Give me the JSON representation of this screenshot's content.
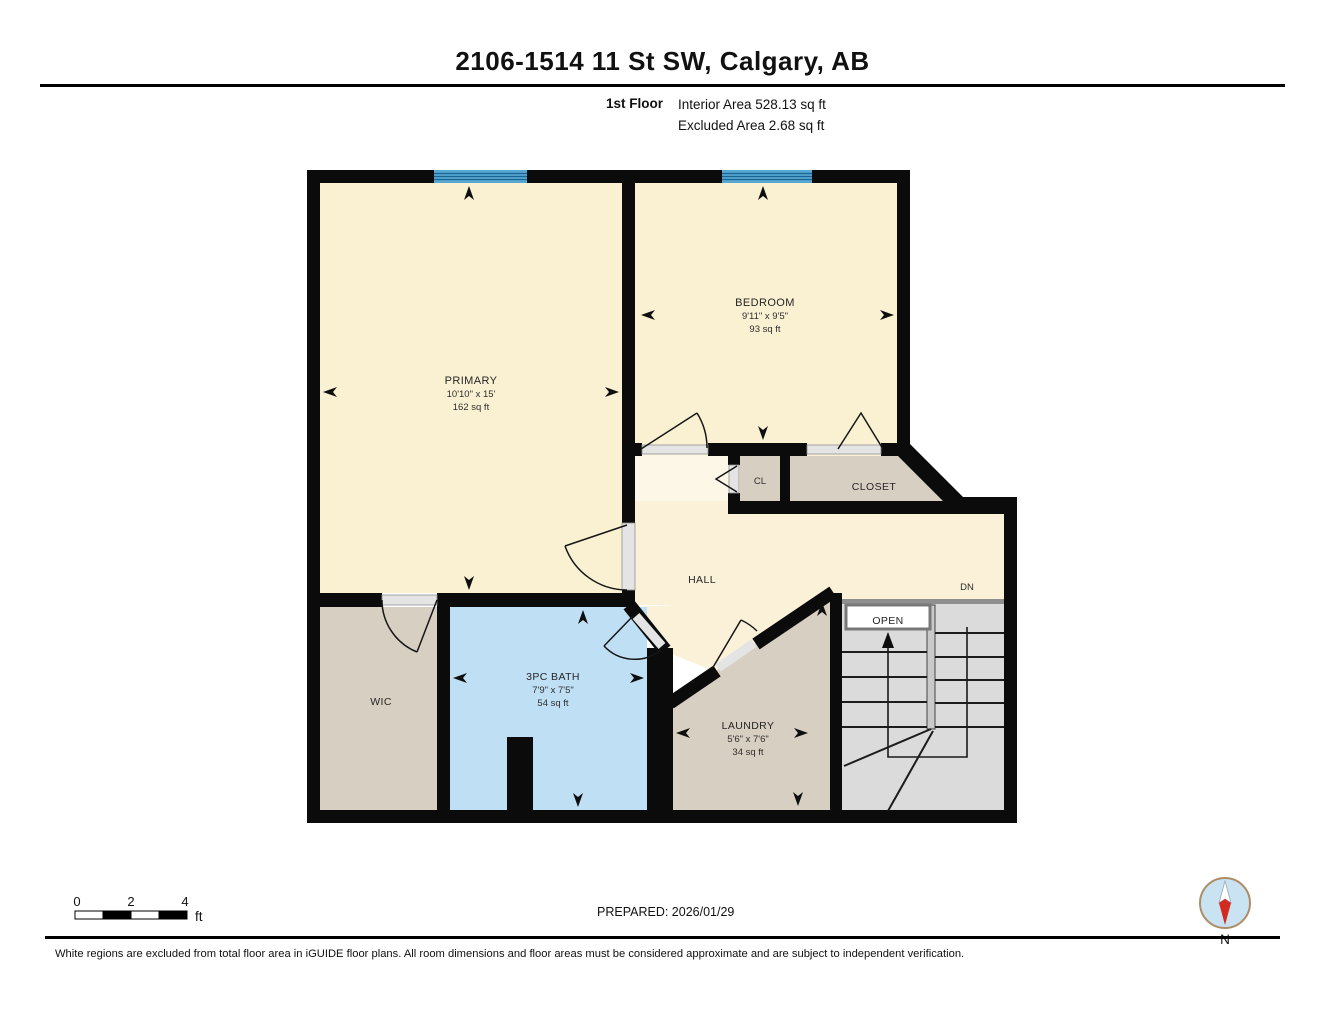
{
  "page": {
    "title": "2106-1514 11 St SW, Calgary, AB"
  },
  "subtitle": {
    "floor": "1st Floor",
    "interior": "Interior Area 528.13 sq ft",
    "excluded": "Excluded Area 2.68 sq ft"
  },
  "rooms": {
    "primary": {
      "label": "PRIMARY",
      "dims": "10'10\" x 15'",
      "area": "162 sq ft"
    },
    "bedroom": {
      "label": "BEDROOM",
      "dims": "9'11\" x 9'5\"",
      "area": "93 sq ft"
    },
    "bath": {
      "label": "3PC BATH",
      "dims": "7'9\" x 7'5\"",
      "area": "54 sq ft"
    },
    "laundry": {
      "label": "LAUNDRY",
      "dims": "5'6\" x 7'6\"",
      "area": "34 sq ft"
    },
    "wic": {
      "label": "WIC"
    },
    "hall": {
      "label": "HALL"
    },
    "cl": {
      "label": "CL"
    },
    "closet": {
      "label": "CLOSET"
    },
    "stairs": {
      "dn": "DN",
      "open": "OPEN"
    }
  },
  "scale_bar": {
    "labels": [
      "0",
      "2",
      "4"
    ],
    "unit": "ft"
  },
  "footer": {
    "prepared": "PREPARED: 2026/01/29",
    "disclaimer": "White regions are excluded from total floor area in iGUIDE floor plans. All room dimensions and floor areas must be considered approximate and are subject to independent verification.",
    "compass": "N"
  },
  "colors": {
    "room_fill": "#FAF0D2",
    "closet_fill": "#D8CFC3",
    "bath_fill": "#BFDFF5",
    "stair_fill": "#DBDBDB",
    "window": "#57A7D3",
    "wall": "#0B0B0B"
  }
}
